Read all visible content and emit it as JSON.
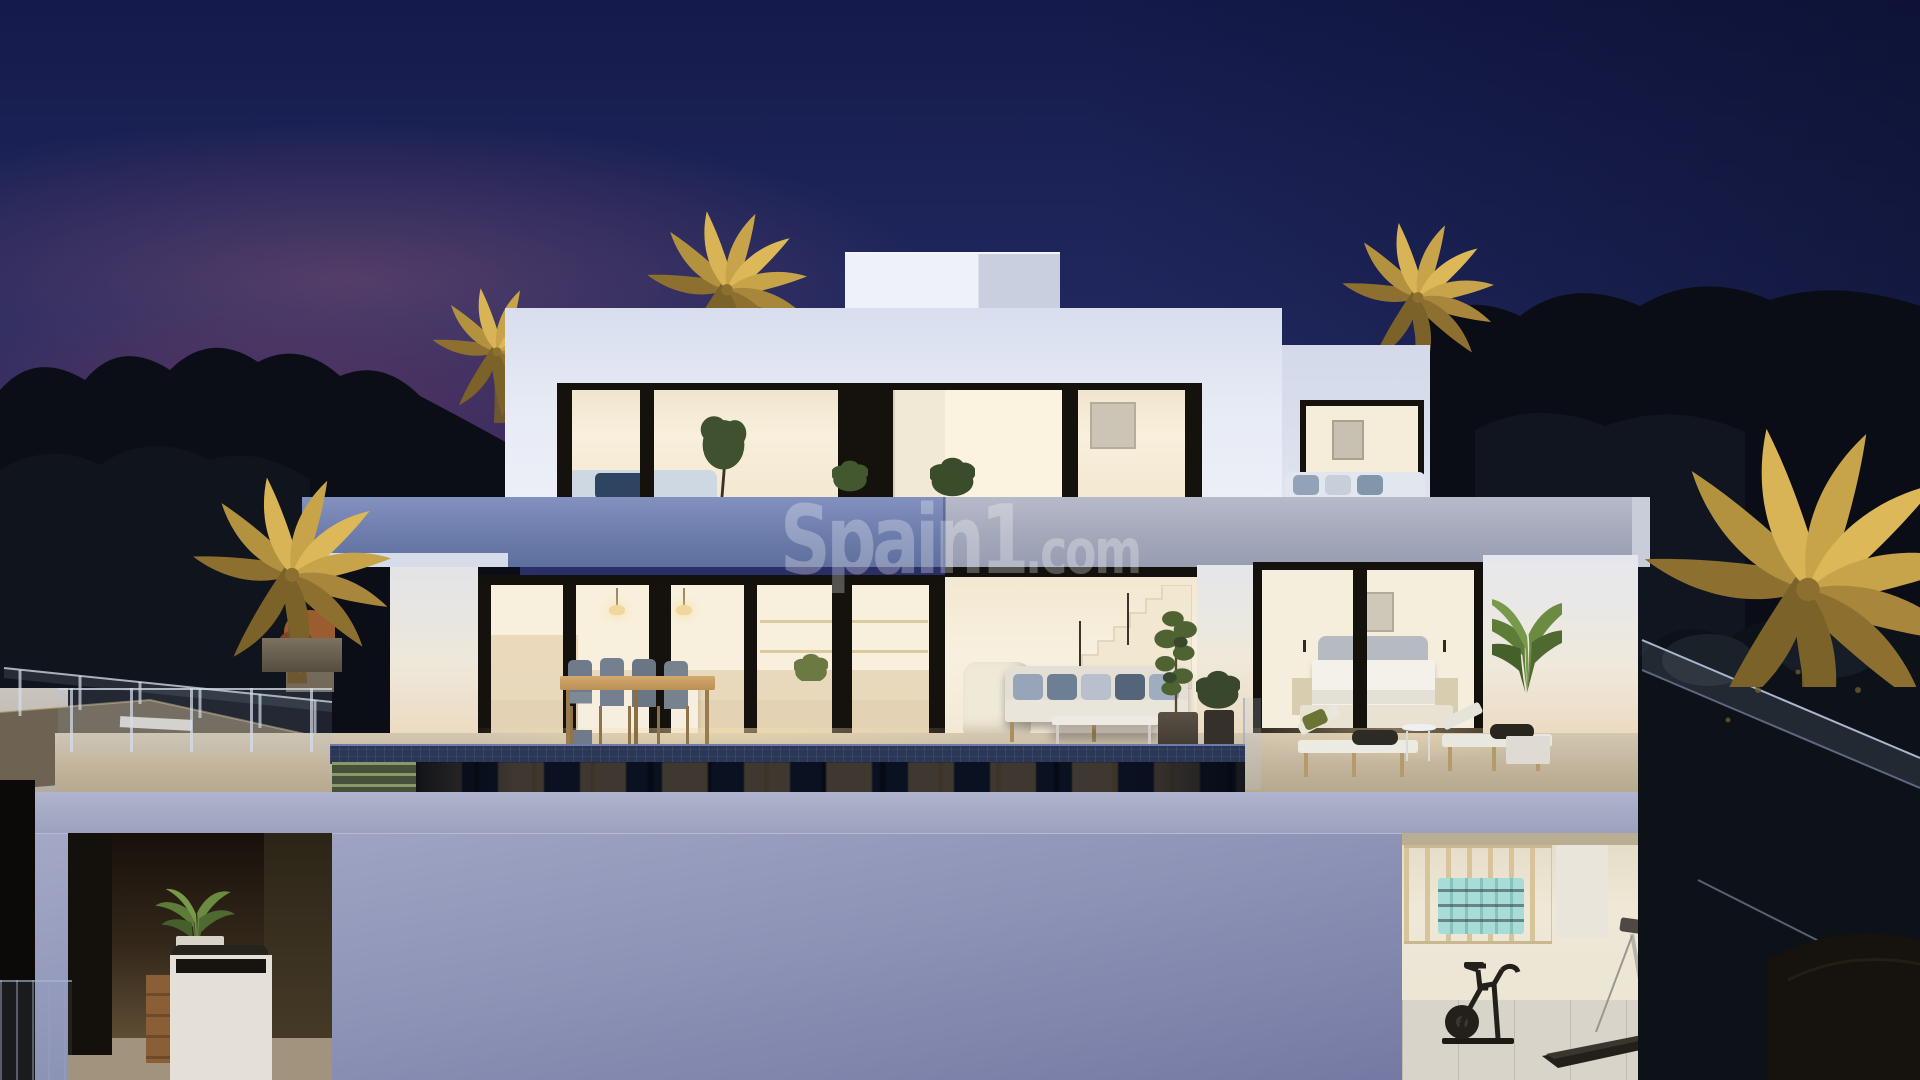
{
  "watermark": {
    "brand": "Spain1",
    "tld": ".com"
  },
  "scene": {
    "title": "Night-time 3D render of a modern two-storey luxury villa",
    "time_of_day": "dusk",
    "features": [
      "deep navy dusk sky with pink sunset band on the left",
      "uplit golden palm trees around the house",
      "white cubic villa with flat roof and stair bulkhead",
      "upper floor with black-framed glass walls and warm lit interior",
      "wide periwinkle balcony slab across the facade",
      "ground floor with kitchen, dining table, living room stairs and bedroom behind glass",
      "outdoor dining set, lounge sofa and two sun loungers on the terrace",
      "infinity pool with dark blue mosaic tiles reflecting the windows",
      "lower level with covered spa patio on the left and open gym on the right",
      "gym with wall bars, mint mat rolls, exercise bike and treadmill",
      "glass railings descending the hillside on both sides"
    ],
    "colors": {
      "sky_top": "#141a4a",
      "sky_dusk": "#2a3067",
      "sunset_pink": "#a4607c",
      "sunset_crimson": "#8e3454",
      "palm_glow": "#d8b456",
      "villa_white": "#eef1f8",
      "slab_periwinkle": "#6c7cab",
      "interior_warm": "#f6ecd6",
      "frame_dark": "#15120e",
      "pool_water": "#0a1120",
      "pool_tile": "#31406a",
      "lower_wall": "#8d93b6",
      "terrace_beige": "#c3b59c",
      "mat_mint": "#a8dcd6"
    }
  }
}
